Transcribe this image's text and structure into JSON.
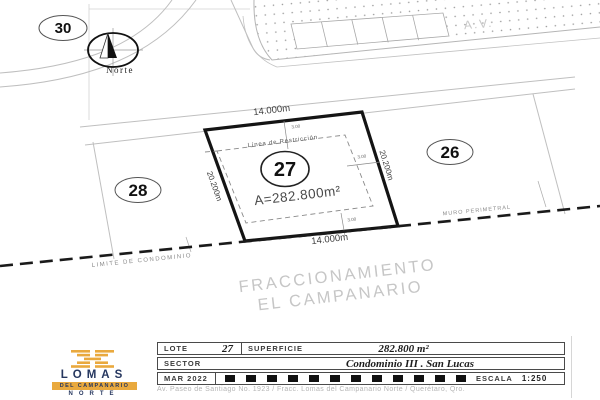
{
  "plan": {
    "lot_current": "27",
    "lot_left": "28",
    "lot_right": "26",
    "lot_top_left": "30",
    "area_label": "A=282.800m²",
    "restriction_label": "Línea de Restricción",
    "dim_top": "14.000m",
    "dim_bottom": "14.000m",
    "dim_left": "20.200m",
    "dim_right": "20.200m",
    "setback_top": "3.00",
    "setback_right": "3.00",
    "setback_bottom": "3.00",
    "street_label": "A.V.",
    "north_label": "Norte",
    "condo_limit_label": "LIMITE DE CONDOMINIO",
    "perimeter_wall_label": "MURO PERIMETRAL",
    "subdivision_line1": "FRACCIONAMIENTO",
    "subdivision_line2": "EL CAMPANARIO"
  },
  "title_block": {
    "lote_label": "LOTE",
    "lote_value": "27",
    "superficie_label": "SUPERFICIE",
    "superficie_value": "282.800 m²",
    "sector_label": "SECTOR",
    "sector_value": "Condominio III . San Lucas",
    "date": "MAR 2022",
    "escala_label": "ESCALA",
    "escala_value": "1:250"
  },
  "logo": {
    "line1": "LOMAS",
    "line2": "DEL CAMPANARIO",
    "line3": "NORTE",
    "gold": "#E9A93E",
    "navy": "#26375F"
  },
  "footer": {
    "address": "Av. Paseo de Santiago No. 1923 / Fracc. Lomas del Campanario Norte / Querétaro, Qro."
  }
}
